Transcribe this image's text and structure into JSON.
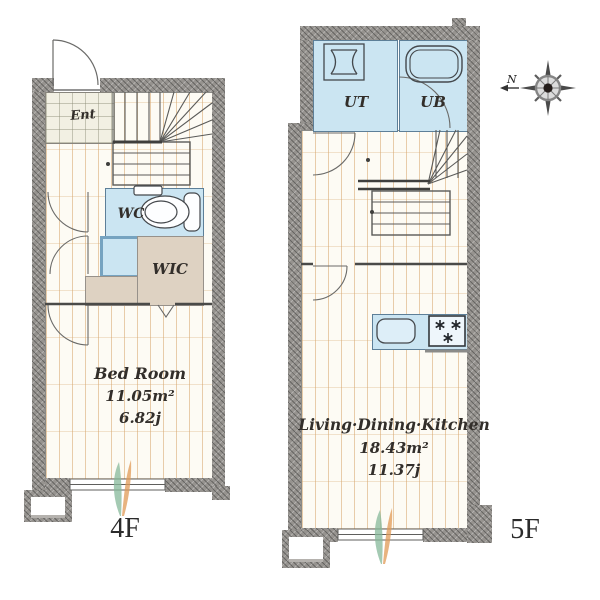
{
  "compass": {
    "north_label": "N"
  },
  "floors": {
    "f4": {
      "label": "4F",
      "rooms": {
        "entrance": {
          "label": "Ent"
        },
        "wc": {
          "label": "WC"
        },
        "wic": {
          "label": "WIC"
        },
        "bedroom": {
          "label": "Bed Room",
          "area_m2": "11.05m²",
          "area_jo": "6.82j"
        }
      }
    },
    "f5": {
      "label": "5F",
      "rooms": {
        "ut": {
          "label": "UT"
        },
        "ub": {
          "label": "UB"
        },
        "ldk": {
          "label": "Living·Dining·Kitchen",
          "area_m2": "18.43m²",
          "area_jo": "11.37j"
        }
      }
    }
  },
  "colors": {
    "wall_gray": "#96938f",
    "wet_area_blue": "#cbe5f2",
    "closet_tan": "#ded2c2",
    "wood_floor": "#fdfbf4",
    "entrance_tile": "#f2f0e3",
    "plant_green": "#86b89a",
    "plant_orange": "#e09a55"
  }
}
